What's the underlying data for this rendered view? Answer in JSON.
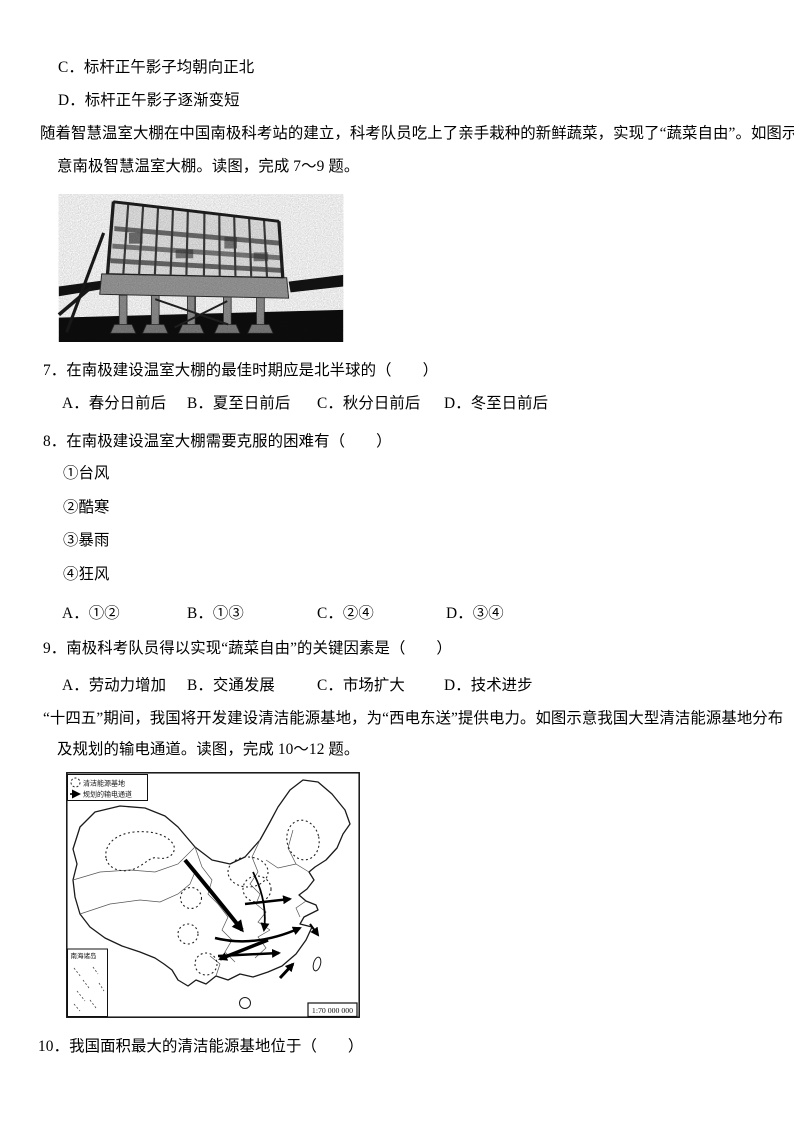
{
  "prelude": {
    "option_c": "C．标杆正午影子均朝向正北",
    "option_d": "D．标杆正午影子逐渐变短"
  },
  "passage1": {
    "line1": "随着智慧温室大棚在中国南极科考站的建立，科考队员吃上了亲手栽种的新鲜蔬菜，实现了“蔬菜自由”。如图示",
    "line2": "意南极智慧温室大棚。读图，完成 7～9 题。"
  },
  "q7": {
    "stem": "7．在南极建设温室大棚的最佳时期应是北半球的（　　）",
    "options": [
      "A．春分日前后",
      "B．夏至日前后",
      "C．秋分日前后",
      "D．冬至日前后"
    ]
  },
  "q8": {
    "stem": "8．在南极建设温室大棚需要克服的困难有（　　）",
    "items": [
      "①台风",
      "②酷寒",
      "③暴雨",
      "④狂风"
    ],
    "options": [
      "A．①②",
      "B．①③",
      "C．②④",
      "D．③④"
    ]
  },
  "q9": {
    "stem": "9．南极科考队员得以实现“蔬菜自由”的关键因素是（　　）",
    "options": [
      "A．劳动力增加",
      "B．交通发展",
      "C．市场扩大",
      "D．技术进步"
    ]
  },
  "passage2": {
    "line1": "“十四五”期间，我国将开发建设清洁能源基地，为“西电东送”提供电力。如图示意我国大型清洁能源基地分布",
    "line2": "及规划的输电通道。读图，完成 10～12 题。"
  },
  "map_figure": {
    "legend_base": "清洁能源基地",
    "legend_channel": "规划的输电通道",
    "inset_label": "南海诸岛",
    "scale": "1:70 000 000"
  },
  "q10": {
    "stem": "10．我国面积最大的清洁能源基地位于（　　）"
  }
}
